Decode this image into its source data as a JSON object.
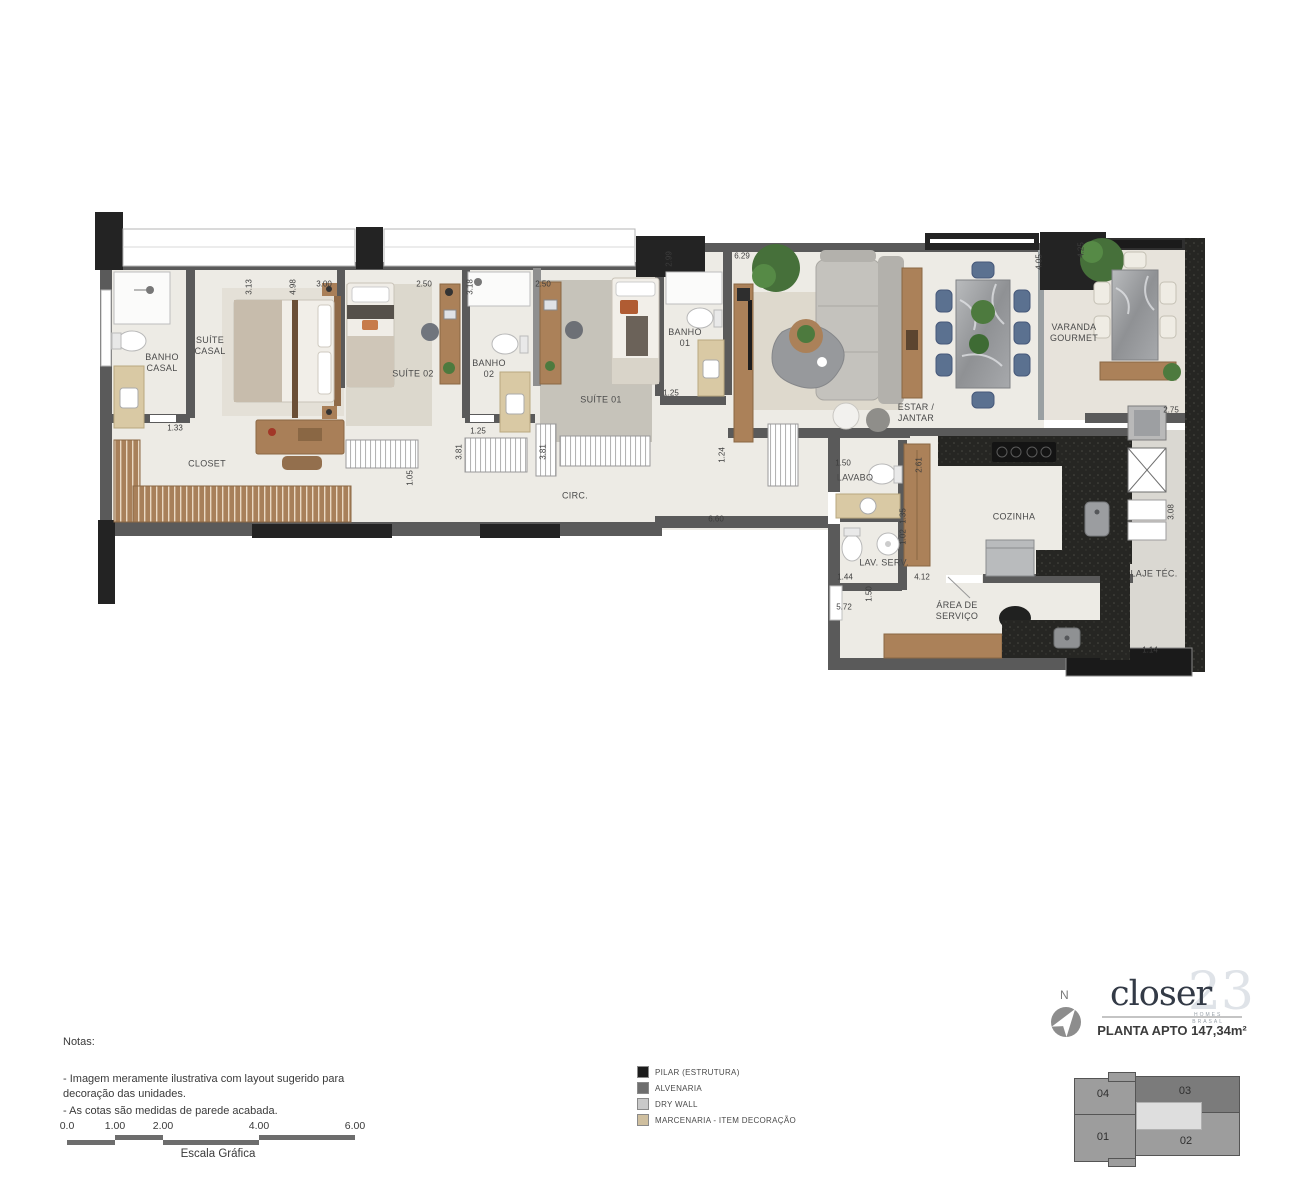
{
  "plan": {
    "rooms": [
      {
        "label": "BANHO\nCASAL",
        "x": 162,
        "y": 363
      },
      {
        "label": "SUÍTE\nCASAL",
        "x": 210,
        "y": 346
      },
      {
        "label": "CLOSET",
        "x": 207,
        "y": 464
      },
      {
        "label": "SUÍTE 02",
        "x": 413,
        "y": 374
      },
      {
        "label": "BANHO\n02",
        "x": 489,
        "y": 369
      },
      {
        "label": "SUÍTE 01",
        "x": 601,
        "y": 400
      },
      {
        "label": "BANHO\n01",
        "x": 685,
        "y": 338
      },
      {
        "label": "CIRC.",
        "x": 575,
        "y": 496
      },
      {
        "label": "ESTAR /\nJANTAR",
        "x": 916,
        "y": 413
      },
      {
        "label": "VARANDA\nGOURMET",
        "x": 1074,
        "y": 333
      },
      {
        "label": "LAVABO",
        "x": 855,
        "y": 478
      },
      {
        "label": "COZINHA",
        "x": 1014,
        "y": 517
      },
      {
        "label": "LAV. SERV.",
        "x": 884,
        "y": 563
      },
      {
        "label": "ÁREA DE\nSERVIÇO",
        "x": 957,
        "y": 611
      },
      {
        "label": "LAJE TÉC.",
        "x": 1154,
        "y": 574
      }
    ],
    "dimensions": [
      {
        "t": "3.13",
        "x": 249,
        "y": 287,
        "v": true
      },
      {
        "t": "4.98",
        "x": 293,
        "y": 287,
        "v": true
      },
      {
        "t": "3.00",
        "x": 324,
        "y": 284
      },
      {
        "t": "2.50",
        "x": 424,
        "y": 284
      },
      {
        "t": "3.18",
        "x": 470,
        "y": 287,
        "v": true
      },
      {
        "t": "2.50",
        "x": 543,
        "y": 284
      },
      {
        "t": "2.99",
        "x": 669,
        "y": 259,
        "v": true
      },
      {
        "t": "6.29",
        "x": 742,
        "y": 256
      },
      {
        "t": "4.05",
        "x": 1039,
        "y": 262,
        "v": true
      },
      {
        "t": "4.25",
        "x": 1081,
        "y": 250,
        "v": true
      },
      {
        "t": "1.33",
        "x": 175,
        "y": 428
      },
      {
        "t": "1.25",
        "x": 478,
        "y": 431
      },
      {
        "t": "3.81",
        "x": 459,
        "y": 452,
        "v": true
      },
      {
        "t": "3.81",
        "x": 543,
        "y": 452,
        "v": true
      },
      {
        "t": "1.05",
        "x": 410,
        "y": 478,
        "v": true
      },
      {
        "t": "1.25",
        "x": 671,
        "y": 393
      },
      {
        "t": "1.24",
        "x": 722,
        "y": 455,
        "v": true
      },
      {
        "t": "6.60",
        "x": 716,
        "y": 519
      },
      {
        "t": "1.50",
        "x": 843,
        "y": 463
      },
      {
        "t": "2.61",
        "x": 919,
        "y": 465,
        "v": true
      },
      {
        "t": "1.35",
        "x": 903,
        "y": 516,
        "v": true
      },
      {
        "t": "1.02",
        "x": 903,
        "y": 537,
        "v": true
      },
      {
        "t": "1.44",
        "x": 845,
        "y": 577
      },
      {
        "t": "4.12",
        "x": 922,
        "y": 577
      },
      {
        "t": "1.50",
        "x": 869,
        "y": 594,
        "v": true
      },
      {
        "t": "5.72",
        "x": 844,
        "y": 607
      },
      {
        "t": "2.75",
        "x": 1171,
        "y": 410
      },
      {
        "t": "3.08",
        "x": 1171,
        "y": 512,
        "v": true
      },
      {
        "t": "1.14",
        "x": 1150,
        "y": 650
      }
    ]
  },
  "notes": {
    "title": "Notas:",
    "lines": [
      "- Imagem meramente ilustrativa com layout sugerido para\ndecoração das unidades.",
      "- As cotas são medidas de parede acabada."
    ]
  },
  "scale_bar": {
    "ticks": [
      "0.0",
      "1.00",
      "2.00",
      "4.00",
      "6.00"
    ],
    "caption": "Escala Gráfica"
  },
  "legend": {
    "items": [
      {
        "label": "PILAR (ESTRUTURA)",
        "color": "#1c1c1c"
      },
      {
        "label": "ALVENARIA",
        "color": "#6e6e6e"
      },
      {
        "label": "DRY WALL",
        "color": "#c9c9c9"
      },
      {
        "label": "MARCENARIA - ITEM DECORAÇÃO",
        "color": "#cfbf9f"
      }
    ]
  },
  "title_block": {
    "north_label": "N",
    "logo_text": "closer",
    "logo_number": "23",
    "logo_sub1": "HOMES",
    "logo_sub2": "BRASAL",
    "plan_title": "PLANTA APTO 147,34m²"
  },
  "key_plan": {
    "units": [
      {
        "label": "04",
        "x": 31,
        "y": 22
      },
      {
        "label": "03",
        "x": 113,
        "y": 19
      },
      {
        "label": "01",
        "x": 31,
        "y": 65
      },
      {
        "label": "02",
        "x": 114,
        "y": 69
      }
    ]
  },
  "colors": {
    "wall": "#5a5a5a",
    "pillar": "#232323",
    "wood": "#ab8159",
    "marcenaria": "#d9c9a4",
    "granite": "#262623",
    "chair_blue": "#5b7190",
    "plant": "#46703a",
    "floor": "#edebe5"
  }
}
